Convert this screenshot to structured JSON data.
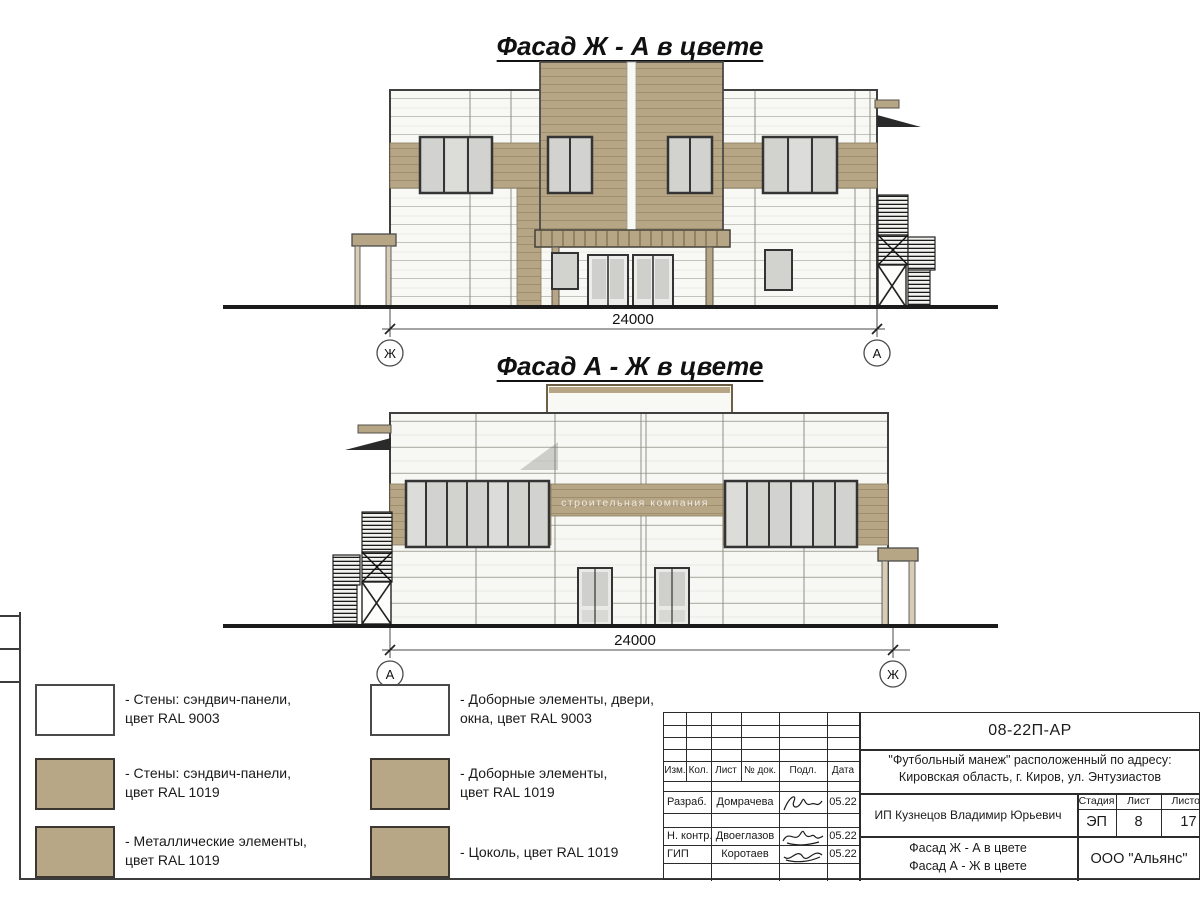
{
  "facade1": {
    "title": "Фасад Ж - А в цвете",
    "dimension": "24000",
    "axis_left": "Ж",
    "axis_right": "А"
  },
  "facade2": {
    "title": "Фасад А - Ж в цвете",
    "dimension": "24000",
    "axis_left": "А",
    "axis_right": "Ж",
    "watermark": "строительная компания"
  },
  "legend": {
    "column1": [
      {
        "color": "#ffffff",
        "label": "- Стены: сэндвич-панели,\nцвет RAL 9003"
      },
      {
        "color": "#b7a786",
        "label": "- Стены: сэндвич-панели,\nцвет RAL 1019"
      },
      {
        "color": "#b7a786",
        "label": "- Металлические элементы,\nцвет RAL 1019"
      }
    ],
    "column2": [
      {
        "color": "#ffffff",
        "label": "- Доборные элементы, двери,\nокна, цвет RAL 9003"
      },
      {
        "color": "#b7a786",
        "label": "- Доборные элементы,\nцвет RAL 1019"
      },
      {
        "color": "#b7a786",
        "label": "- Цоколь, цвет RAL 1019"
      }
    ]
  },
  "title_block": {
    "doc_number": "08-22П-АР",
    "project_address_line1": "\"Футбольный манеж\" расположенный по адресу:",
    "project_address_line2": "Кировская область, г. Киров, ул. Энтузиастов",
    "columns": [
      "Изм.",
      "Кол.",
      "Лист",
      "№ док.",
      "Подл.",
      "Дата"
    ],
    "signature_rows": [
      {
        "role": "Разраб.",
        "name": "Домрачева",
        "date": "05.22"
      },
      {
        "role": "Н. контр.",
        "name": "Двоеглазов",
        "date": "05.22"
      },
      {
        "role": "ГИП",
        "name": "Коротаев",
        "date": "05.22"
      }
    ],
    "client": "ИП Кузнецов Владимир Юрьевич",
    "stage_label": "Стадия",
    "sheet_label": "Лист",
    "sheets_label": "Листов",
    "stage_value": "ЭП",
    "sheet_value": "8",
    "sheets_value": "17",
    "drawing_title_line1": "Фасад Ж - А в цвете",
    "drawing_title_line2": "Фасад А - Ж в цвете",
    "company": "ООО \"Альянс\""
  },
  "colors": {
    "panel_white_ral9003": "#f8f8f4",
    "panel_tan_ral1019": "#b6a686",
    "window_glass": "#d2d2cf"
  }
}
